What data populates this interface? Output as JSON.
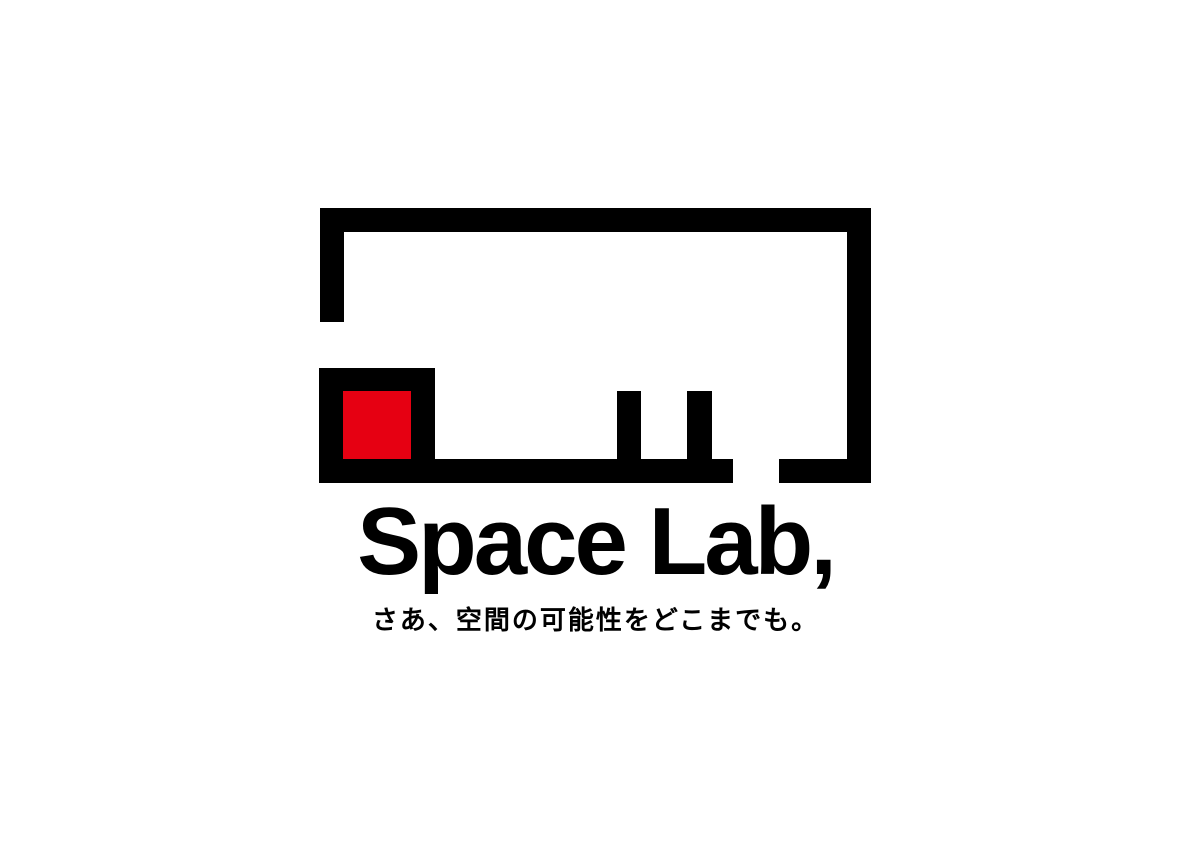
{
  "brand": {
    "wordmark": "Space Lab,",
    "tagline": "さあ、空間の可能性をどこまでも。"
  },
  "logo": {
    "mark_name": "floorplan-room-mark",
    "mark_description": "abstract room outline with open doorway, counter box, red accent square and two table legs",
    "accent_shape": "red-square"
  },
  "colors": {
    "ink": "#000000",
    "accent_red": "#e60012",
    "background": "#ffffff"
  }
}
